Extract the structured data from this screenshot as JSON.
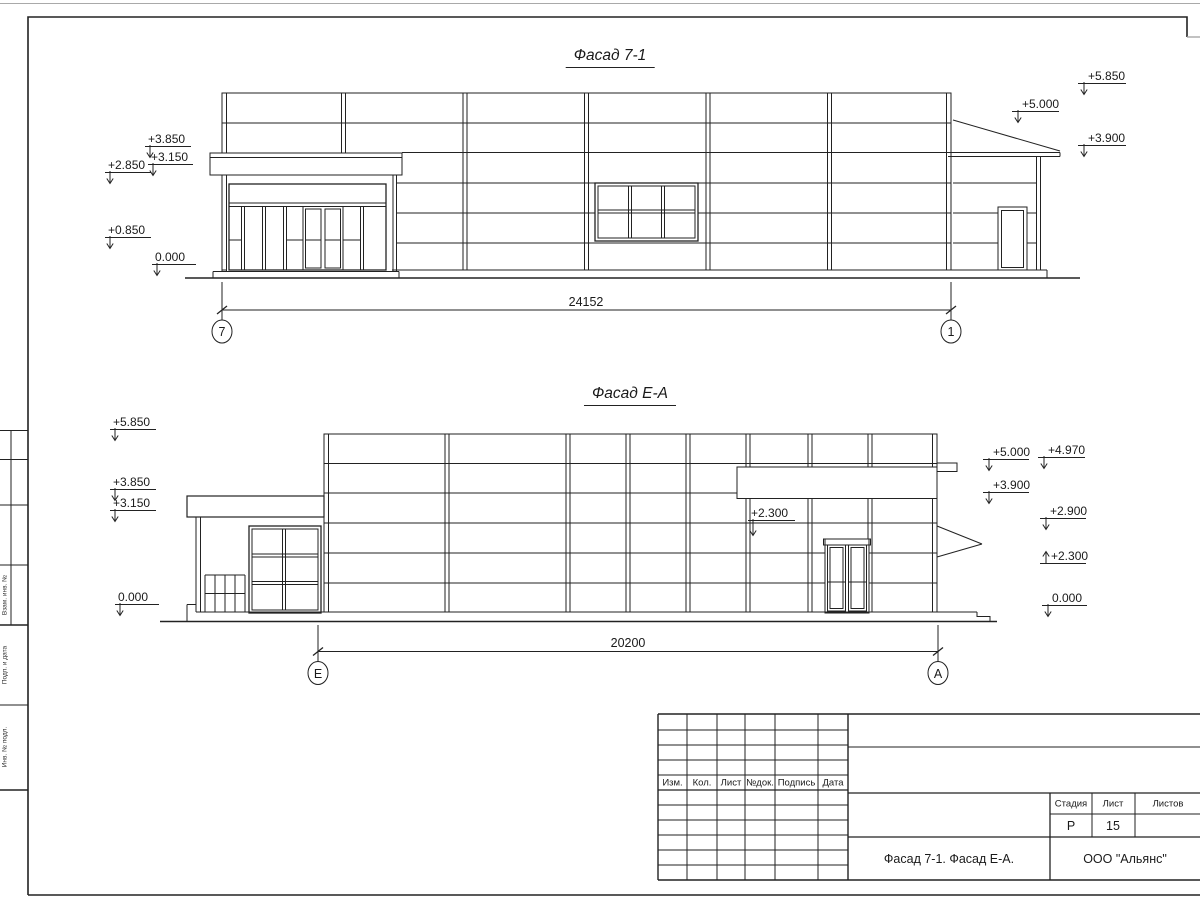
{
  "page": {
    "background": "#ffffff",
    "line_color": "#222222"
  },
  "facade1": {
    "title": "Фасад 7-1",
    "dimension": "24152",
    "axis_left": "7",
    "axis_right": "1",
    "elev_left": [
      "+3.850",
      "+3.150",
      "+2.850",
      "+0.850",
      "0.000"
    ],
    "elev_right": [
      "+5.850",
      "+5.000",
      "+3.900"
    ]
  },
  "facade2": {
    "title": "Фасад Е-А",
    "dimension": "20200",
    "axis_left": "Е",
    "axis_right": "А",
    "elev_left": [
      "+5.850",
      "+3.850",
      "+3.150",
      "0.000"
    ],
    "elev_right_col1": [
      "+5.000",
      "+3.900"
    ],
    "elev_right_col2": [
      "+4.970",
      "+2.900",
      "+2.300",
      "0.000"
    ],
    "elev_inner": "+2.300"
  },
  "title_block": {
    "revision_headers": [
      "Изм.",
      "Кол.",
      "Лист",
      "№док.",
      "Подпись",
      "Дата"
    ],
    "stage_label": "Стадия",
    "sheet_label": "Лист",
    "sheets_label": "Листов",
    "stage_value": "Р",
    "sheet_value": "15",
    "sheets_value": "",
    "drawing_title": "Фасад 7-1. Фасад Е-А.",
    "company": "ООО \"Альянс\""
  },
  "side_strip": {
    "labels": [
      "Взам. инв. №",
      "Подп. и дата",
      "Инв. № подл."
    ]
  }
}
